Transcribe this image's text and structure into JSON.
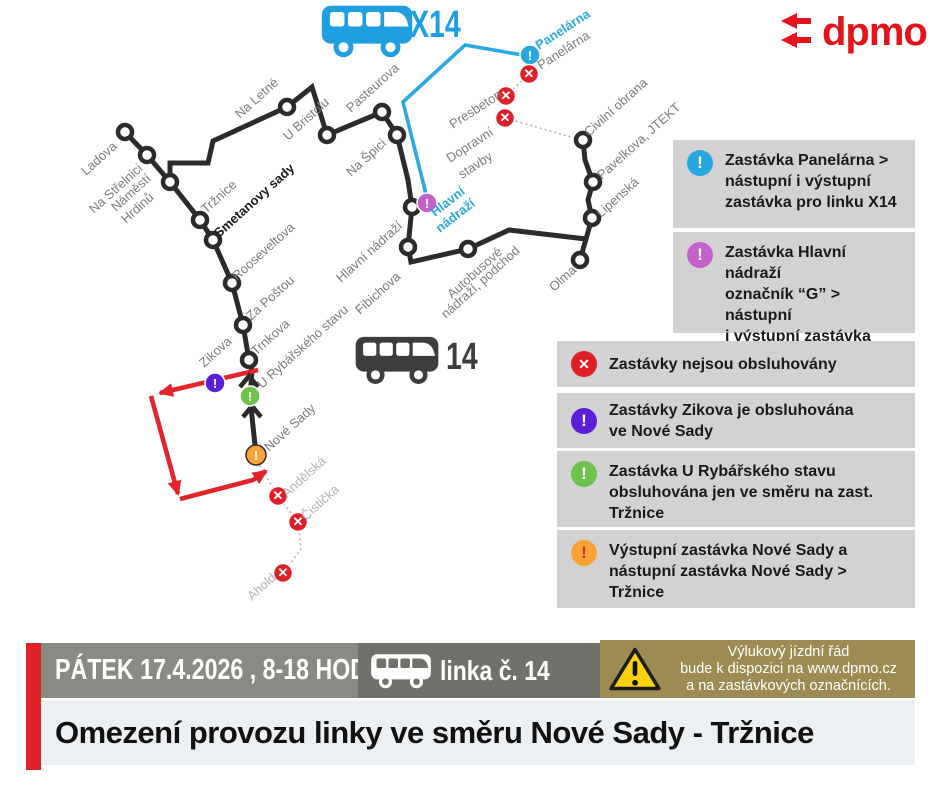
{
  "header": {
    "logo_text": "dpmo",
    "x14_label": "X14",
    "line14_label": "14"
  },
  "colors": {
    "route_black": "#2b2b2b",
    "route_blue": "#2aa9e2",
    "route_red": "#e2252b",
    "badge_blue": "#27a7e0",
    "badge_magenta": "#c55fc9",
    "badge_violet": "#5a1ed6",
    "badge_green": "#6ec24e",
    "badge_orange": "#f8a335",
    "badge_redx": "#df1f26",
    "logo_red": "#e3141c",
    "banner_olive": "#9c8c52"
  },
  "map": {
    "black_paths": [
      "M125,132 L147,155 L170,182 L200,220 L213,240 L232,283 L243,325 L249,360 L252,371 L250,397 L256,455",
      "M170,182 L170,163 L208,163 L213,141 L287,107 L312,87 L327,135 L382,112 L397,135 L408,180 L412,207 L408,247 L411,262 L468,249 L509,230 L586,239 L592,218 L588,200 L593,182 L585,160 L583,140",
      "M586,239 L580,260"
    ],
    "blue_path": "M427,199 L424,186 L403,102 L465,45 L528,56",
    "red_paths": [
      "M258,370 L160,393",
      "M151,396 L178,494",
      "M180,499 L253,480 L266,471"
    ],
    "dotted_paths": [
      "M529,74 L506,96 L505,118 L578,139",
      "M257,461 L278,496 L298,522 L301,549 L284,572"
    ],
    "direction_arrows": [
      "M240,387 L249,376 L258,387",
      "M243,417 L252,406 L261,417"
    ],
    "stops": [
      [
        125,
        132
      ],
      [
        147,
        155
      ],
      [
        170,
        182
      ],
      [
        200,
        220
      ],
      [
        213,
        240
      ],
      [
        232,
        283
      ],
      [
        243,
        325
      ],
      [
        249,
        360
      ],
      [
        287,
        107
      ],
      [
        327,
        135
      ],
      [
        382,
        112
      ],
      [
        397,
        135
      ],
      [
        412,
        207
      ],
      [
        408,
        247
      ],
      [
        468,
        249
      ],
      [
        583,
        140
      ],
      [
        593,
        182
      ],
      [
        592,
        218
      ],
      [
        580,
        260
      ]
    ],
    "badges": [
      {
        "x": 530,
        "y": 55,
        "k": "blue"
      },
      {
        "x": 529,
        "y": 74,
        "k": "redx"
      },
      {
        "x": 506,
        "y": 96,
        "k": "redx"
      },
      {
        "x": 505,
        "y": 118,
        "k": "redx"
      },
      {
        "x": 427,
        "y": 203,
        "k": "magenta"
      },
      {
        "x": 215,
        "y": 383,
        "k": "violet"
      },
      {
        "x": 250,
        "y": 396,
        "k": "green"
      },
      {
        "x": 256,
        "y": 455,
        "k": "orange"
      },
      {
        "x": 278,
        "y": 496,
        "k": "redx"
      },
      {
        "x": 298,
        "y": 522,
        "k": "redx"
      },
      {
        "x": 283,
        "y": 573,
        "k": "redx"
      }
    ],
    "labels": [
      {
        "t": "Ladova",
        "x": 86,
        "y": 176,
        "r": -42,
        "c": "g"
      },
      {
        "t": "Na Střelnici",
        "x": 94,
        "y": 214,
        "r": -42,
        "c": "g"
      },
      {
        "t": "Náměstí",
        "x": 116,
        "y": 212,
        "r": -42,
        "c": "g"
      },
      {
        "t": "Hrdinů",
        "x": 126,
        "y": 224,
        "r": -42,
        "c": "g"
      },
      {
        "t": "Tržnice",
        "x": 206,
        "y": 214,
        "r": -42,
        "c": "g"
      },
      {
        "t": "Smetanovy sady",
        "x": 219,
        "y": 238,
        "r": -42,
        "c": "d"
      },
      {
        "t": "Rooseveltova",
        "x": 237,
        "y": 281,
        "r": -42,
        "c": "g"
      },
      {
        "t": "Za Poštou",
        "x": 251,
        "y": 321,
        "r": -42,
        "c": "g"
      },
      {
        "t": "Trnkova",
        "x": 256,
        "y": 356,
        "r": -42,
        "c": "g"
      },
      {
        "t": "Zikova",
        "x": 204,
        "y": 368,
        "r": -42,
        "c": "g"
      },
      {
        "t": "U Rybářského stavu",
        "x": 262,
        "y": 389,
        "r": -42,
        "c": "g"
      },
      {
        "t": "Nové Sady",
        "x": 269,
        "y": 452,
        "r": -42,
        "c": "g"
      },
      {
        "t": "Andělská",
        "x": 287,
        "y": 498,
        "r": -42,
        "c": "l"
      },
      {
        "t": "Čistička",
        "x": 306,
        "y": 521,
        "r": -42,
        "c": "l"
      },
      {
        "t": "Ahold",
        "x": 252,
        "y": 601,
        "r": -42,
        "c": "l"
      },
      {
        "t": "Na Letné",
        "x": 240,
        "y": 119,
        "r": -42,
        "c": "g"
      },
      {
        "t": "U Bristolu",
        "x": 288,
        "y": 141,
        "r": -42,
        "c": "g"
      },
      {
        "t": "Pasteurova",
        "x": 351,
        "y": 113,
        "r": -42,
        "c": "g"
      },
      {
        "t": "Na Špici",
        "x": 351,
        "y": 177,
        "r": -42,
        "c": "g"
      },
      {
        "t": "Hlavní nádraží",
        "x": 341,
        "y": 283,
        "r": -42,
        "c": "g"
      },
      {
        "t": "Fibichova",
        "x": 360,
        "y": 315,
        "r": -42,
        "c": "g"
      },
      {
        "t": "Autobusové",
        "x": 452,
        "y": 299,
        "r": -42,
        "c": "g"
      },
      {
        "t": "nádraží, podchod",
        "x": 446,
        "y": 319,
        "r": -42,
        "c": "g"
      },
      {
        "t": "Olma",
        "x": 554,
        "y": 292,
        "r": -42,
        "c": "g"
      },
      {
        "t": "Lipenská",
        "x": 601,
        "y": 218,
        "r": -42,
        "c": "g"
      },
      {
        "t": "Pavelkova, JTEKT",
        "x": 602,
        "y": 180,
        "r": -42,
        "c": "g"
      },
      {
        "t": "Civilní obrana",
        "x": 589,
        "y": 137,
        "r": -42,
        "c": "g"
      },
      {
        "t": "Panelárna",
        "x": 539,
        "y": 50,
        "r": -33,
        "c": "b"
      },
      {
        "t": "Panelárna",
        "x": 541,
        "y": 70,
        "r": -33,
        "c": "g"
      },
      {
        "t": "Presbeton",
        "x": 453,
        "y": 129,
        "r": -33,
        "c": "g"
      },
      {
        "t": "Dopravní",
        "x": 450,
        "y": 163,
        "r": -33,
        "c": "g"
      },
      {
        "t": "stavby",
        "x": 462,
        "y": 179,
        "r": -33,
        "c": "g"
      },
      {
        "t": "Hlavní",
        "x": 435,
        "y": 217,
        "r": -38,
        "c": "b"
      },
      {
        "t": "nádraží",
        "x": 440,
        "y": 233,
        "r": -38,
        "c": "b"
      }
    ]
  },
  "legend": [
    {
      "glyph": "!",
      "lines": [
        "Zastávka Panelárna  >",
        "nástupní i výstupní",
        "zastávka pro linku X14"
      ]
    },
    {
      "glyph": "!",
      "lines": [
        "Zastávka Hlavní nádraží",
        "označník “G” > nástupní",
        "i výstupní zastávka",
        "pro linku X14"
      ]
    },
    {
      "glyph": "✕",
      "lines": [
        "Zastávky nejsou obsluhovány"
      ]
    },
    {
      "glyph": "!",
      "lines": [
        "Zastávky Zikova je obsluhována",
        "ve Nové Sady"
      ]
    },
    {
      "glyph": "!",
      "lines": [
        "Zastávka U Rybářského stavu",
        "obsluhována jen ve směru na  zast.",
        "Tržnice"
      ]
    },
    {
      "glyph": "!",
      "lines": [
        "Výstupní zastávka Nové Sady a",
        "nástupní zastávka Nové Sady >",
        "Tržnice"
      ]
    }
  ],
  "banner": {
    "date_text": "PÁTEK 17.4.2026 , 8-18 HOD.",
    "line_text": "linka č. 14",
    "notice_lines": [
      "Výlukový jízdní řád",
      "bude k dispozici na www.dpmo.cz",
      "a na zastávkových označnících."
    ]
  },
  "title": "Omezení provozu linky ve směru Nové Sady - Tržnice"
}
